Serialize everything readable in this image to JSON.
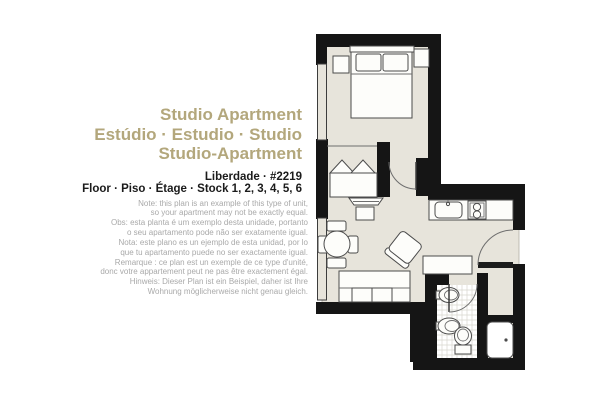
{
  "header": {
    "title_lines": [
      "Studio Apartment",
      "Estúdio · Estudio · Studio",
      "Studio-Apartment"
    ],
    "location_line": "Liberdade · #2219",
    "floor_line": "Floor · Piso · Étage · Stock 1, 2, 3, 4, 5, 6"
  },
  "note": {
    "lines": [
      "Note: this plan is an example of this type of unit,",
      "so your apartment may not be exactly equal.",
      "Obs: esta planta é um exemplo desta unidade, portanto",
      "o seu apartamento pode não ser exatamente igual.",
      "Nota: este plano es un ejemplo de esta unidad, por lo",
      "que tu apartamento puede no ser exactamente igual.",
      "Remarque : ce plan est un exemple de ce type d'unité,",
      "donc votre appartement peut ne pas être exactement égal.",
      "Hinweis: Dieser Plan ist ein Beispiel, daher ist Ihre",
      "Wohnung möglicherweise nicht genau gleich."
    ]
  },
  "colors": {
    "accent": "#b3a77c",
    "text": "#1b1b1b",
    "note": "#a9a9a9",
    "floor": "#e7e4db",
    "wall": "#151515"
  },
  "floorplan": {
    "type": "studio-apartment-plan",
    "elements": [
      "double-bed",
      "pillows",
      "nightstand-left",
      "nightstand-right",
      "bedroom-door",
      "daybed",
      "tv",
      "side-table",
      "dining-table",
      "dining-chairs",
      "armchair",
      "sofa",
      "wardrobe",
      "kitchen-counter",
      "kitchen-sink",
      "stove",
      "entrance-door",
      "bathroom",
      "washbasin",
      "bidet",
      "toilet",
      "bathroom-door",
      "shower",
      "windows"
    ]
  }
}
